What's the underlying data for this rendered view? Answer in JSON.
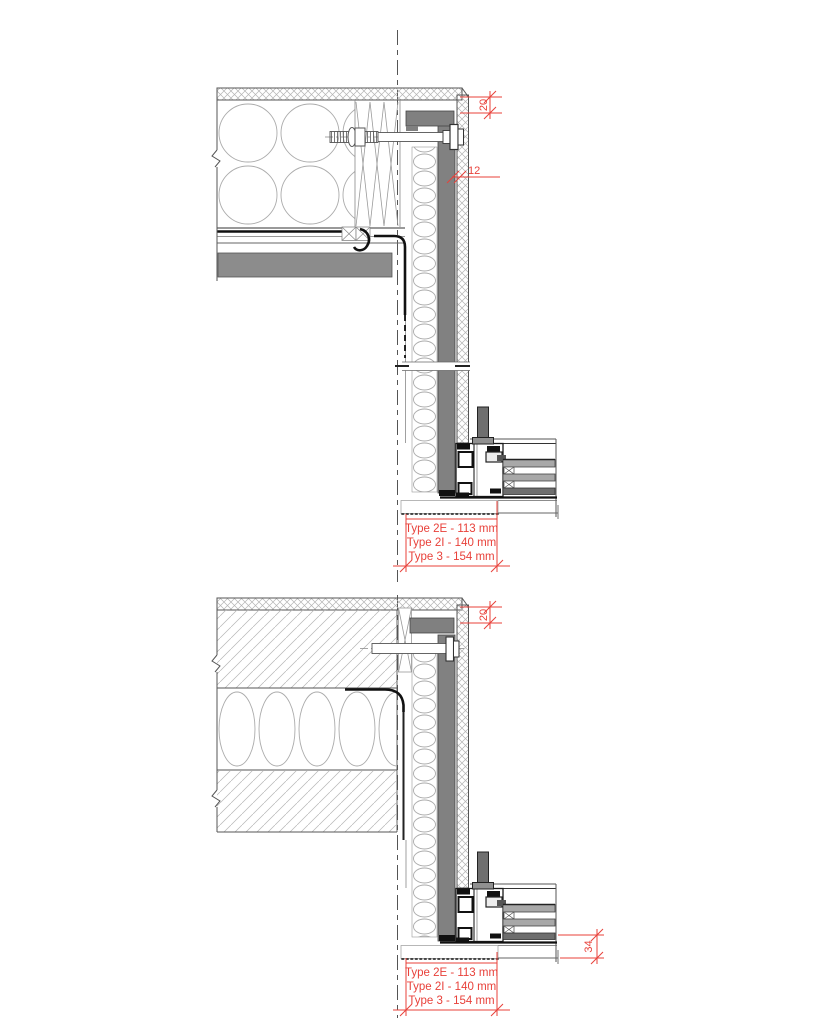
{
  "drawing": {
    "kind": "construction-section-details",
    "colors": {
      "background": "#ffffff",
      "line": "#4a4a4a",
      "red": "#e8413a",
      "panel_gray": "#818181",
      "slab_gray": "#8c8c8c",
      "band_gray": "#808080",
      "glass_gray": "#a8a8a8",
      "glass_dark": "#6e6e6e",
      "stub_gray": "#6f6f6f"
    },
    "details": [
      {
        "name": "top-detail",
        "dimensions": [
          {
            "label": "20"
          },
          {
            "label": "12"
          }
        ],
        "type_labels": [
          "Type 2E - 113 mm",
          "Type 2I - 140 mm",
          "Type 3 - 154 mm"
        ]
      },
      {
        "name": "bottom-detail",
        "dimensions": [
          {
            "label": "20"
          },
          {
            "label": "34"
          }
        ],
        "type_labels": [
          "Type 2E - 113 mm",
          "Type 2I - 140 mm",
          "Type 3 - 154 mm"
        ]
      }
    ]
  }
}
